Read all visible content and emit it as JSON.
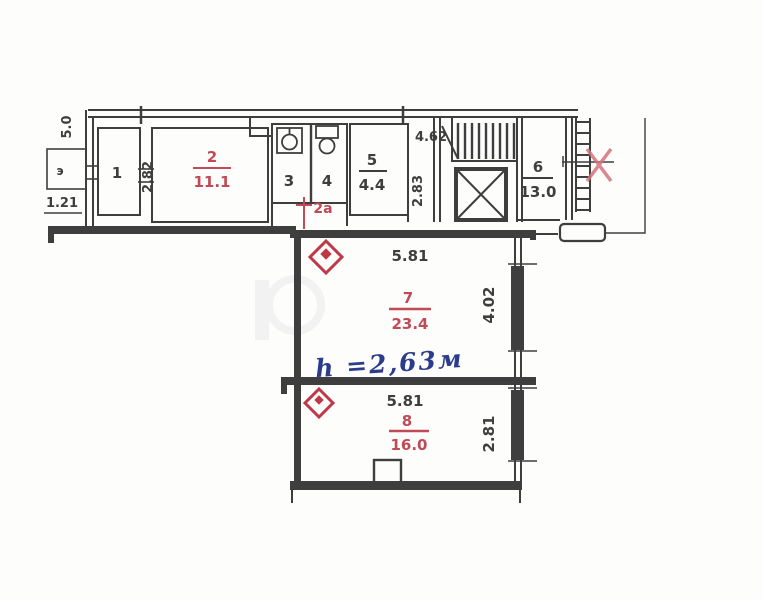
{
  "meta": {
    "type": "apartment-floor-plan"
  },
  "colors": {
    "line": "#3e3e3e",
    "red_accent": "#c04a56",
    "blue_note": "#2c3c8c",
    "paper": "#fdfdfc"
  },
  "rooms": {
    "r1": {
      "number": "1"
    },
    "r2": {
      "number": "2",
      "area": "11.1"
    },
    "r3": {
      "number": "3"
    },
    "r4": {
      "number": "4"
    },
    "r2a": {
      "number": "2а"
    },
    "r5": {
      "number": "5",
      "area": "4.4"
    },
    "r6": {
      "number": "6",
      "area": "13.0"
    },
    "r7": {
      "number": "7",
      "area": "23.4"
    },
    "r8": {
      "number": "8",
      "area": "16.0"
    }
  },
  "dims": {
    "balcony_side": "5.0",
    "balcony_label": "э",
    "balcony_width": "1.21",
    "r2_depth": "2.82",
    "stair_width": "4.62",
    "duct_depth": "2.83",
    "r7_width": "5.81",
    "r7_depth": "4.02",
    "r8_width": "5.81",
    "r8_depth": "2.81"
  },
  "annotations": {
    "ceiling_height_note": "h =2,63м",
    "entry_rejection_mark": "X",
    "corridor_change_mark": "+"
  }
}
